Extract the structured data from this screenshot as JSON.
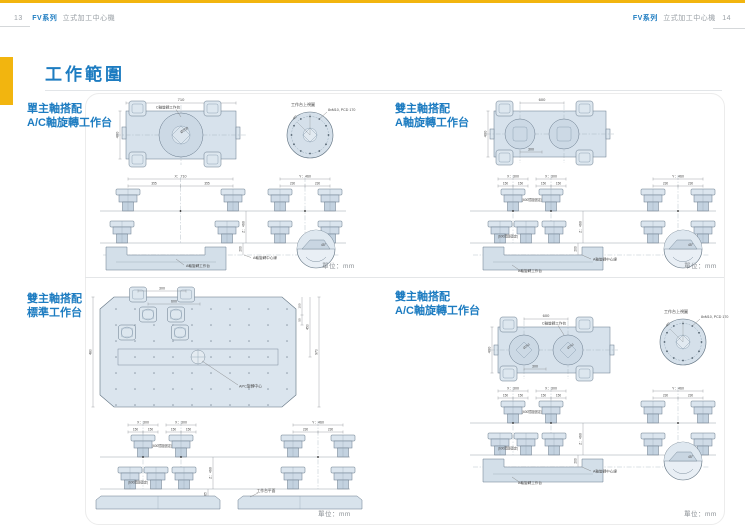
{
  "page": {
    "header": {
      "left_page_no": "13",
      "right_page_no": "14",
      "series": "FV系列",
      "machine_type": "立式加工中心機"
    },
    "title": "工作範圍",
    "unit_label": "單位：mm"
  },
  "sections": [
    {
      "title_line1": "單主軸搭配",
      "title_line2": "A/C軸旋轉工作台"
    },
    {
      "title_line1": "雙主軸搭配",
      "title_line2": "A軸旋轉工作台"
    },
    {
      "title_line1": "雙主軸搭配",
      "title_line2": "標準工作台"
    },
    {
      "title_line1": "雙主軸搭配",
      "title_line2": "A/C軸旋轉工作台"
    }
  ],
  "drawing_labels": {
    "c_axis_table": "C軸旋轉工作台",
    "a_axis_table": "A軸旋轉工作台",
    "a_axis_centerline": "A軸旋轉中心線",
    "table_top_view": "工作台上視圖",
    "bolt_pattern": "8xM10, PCD 170",
    "apc_center": "APC旋轉中心",
    "table_surface": "工作台平面",
    "spacing_note": "(600間距固定)",
    "angle_45": "45°",
    "dia_250": "Ø250"
  },
  "dimensions": {
    "x710": "X：710",
    "x300": "X：300",
    "y460": "Y：460",
    "z460": "Z：460",
    "d355": "355",
    "d230": "230",
    "d150": "150",
    "d200": "200",
    "d65": "65",
    "d710": "710",
    "d600": "600",
    "d400": "400",
    "d300": "300",
    "d480": "480",
    "d970": "970",
    "d450": "450",
    "d100": "100",
    "d50": "50"
  },
  "colors": {
    "accent_yellow": "#F2B50F",
    "accent_blue": "#1D7CC1"
  }
}
